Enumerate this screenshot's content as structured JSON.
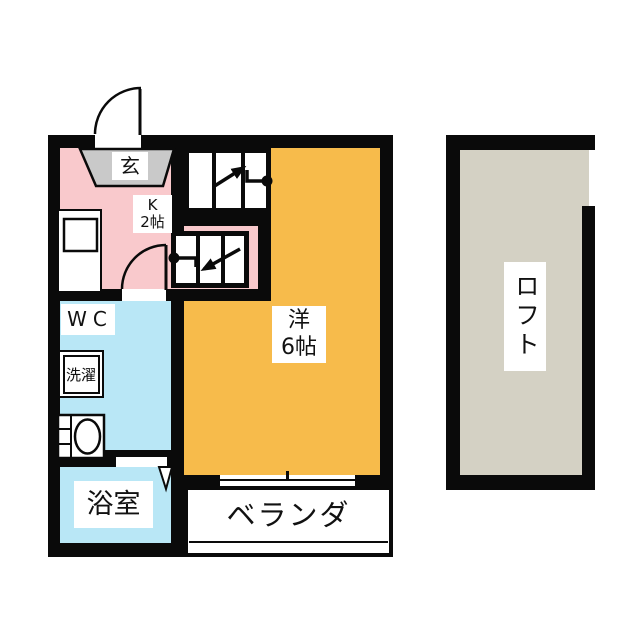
{
  "floorplan": {
    "unit": {
      "entrance_label": "玄",
      "kitchen_label_line1": "K",
      "kitchen_label_line2": "2帖",
      "wc_label": "WC",
      "laundry_label": "洗濯",
      "bath_label": "浴室",
      "room_label_line1": "洋",
      "room_label_line2": "6帖",
      "veranda_label": "ベランダ"
    },
    "loft": {
      "label": "ロフト"
    },
    "colors": {
      "kitchen": "#f9c9cc",
      "room": "#f7bb4b",
      "wet_area": "#b9e7f6",
      "loft": "#d4d1c4",
      "entrance": "#c9c9c9",
      "wall": "#0a0a0a"
    }
  }
}
